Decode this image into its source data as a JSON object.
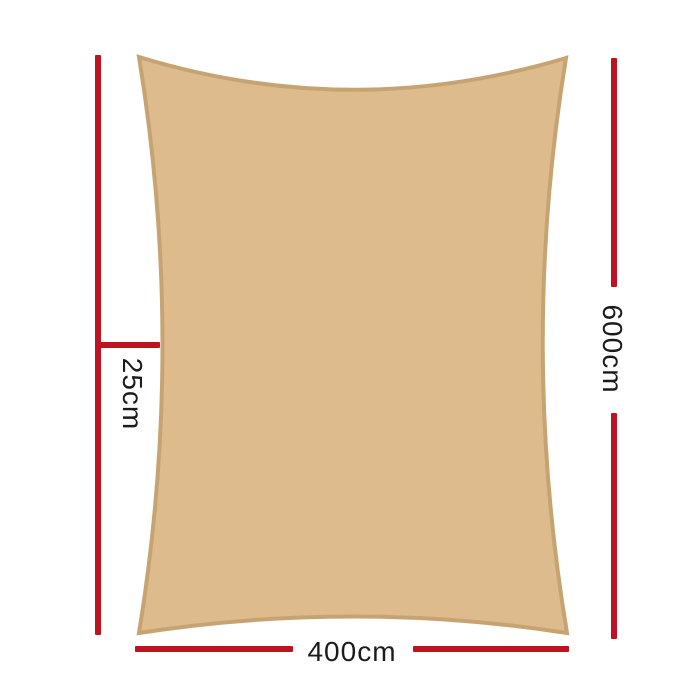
{
  "page": {
    "background": "#ffffff"
  },
  "diagram": {
    "kind": "product-dimension-diagram",
    "product": "rectangle-shade-sail",
    "sail": {
      "shape": "rectangle-concave-edges",
      "fill": "#ddbb8d",
      "stroke": "#c8a372"
    },
    "dimension_line_color": "#bf1322",
    "label_color": "#1b1b1b",
    "measurements": {
      "offset_left": "25cm",
      "height_right": "600cm",
      "width_bottom": "400cm"
    }
  }
}
